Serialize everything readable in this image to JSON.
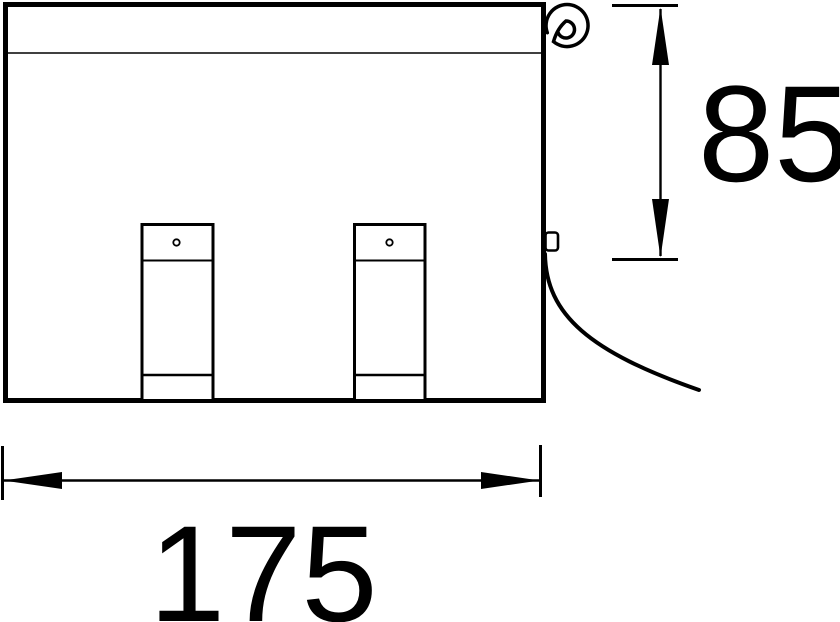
{
  "diagram": {
    "type": "technical-drawing",
    "view": "front-elevation-with-cable",
    "background_color": "#ffffff",
    "line_color": "#000000",
    "dimensions": [
      {
        "id": "overall-width",
        "label": "175",
        "orientation": "horizontal"
      },
      {
        "id": "overall-height",
        "label": "85",
        "orientation": "vertical"
      }
    ]
  }
}
